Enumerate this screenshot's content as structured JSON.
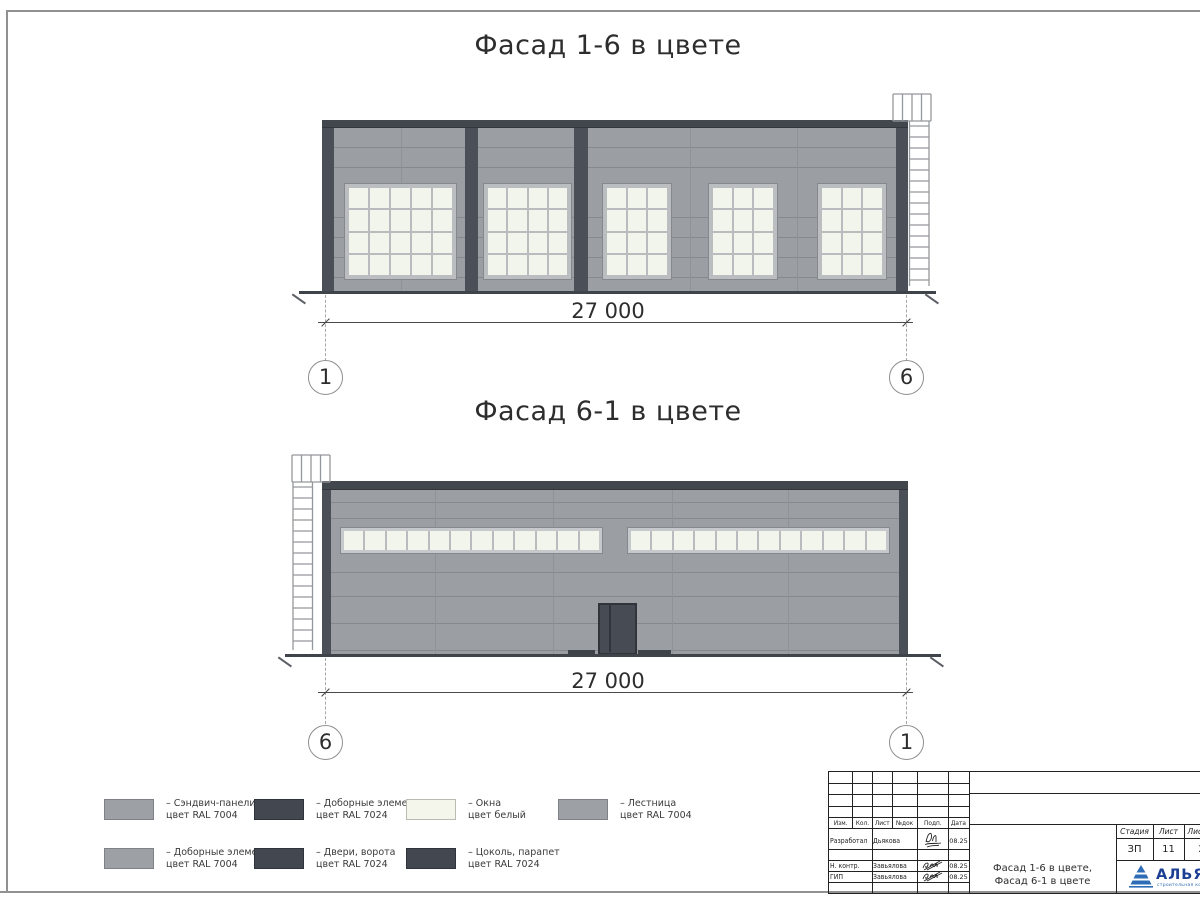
{
  "facade_top": {
    "title": "Фасад 1-6 в цвете",
    "dimension": "27 000",
    "axis_left": "1",
    "axis_right": "6",
    "windows": [
      {
        "cols": 5,
        "rows": 4
      },
      {
        "cols": 4,
        "rows": 4
      },
      {
        "cols": 3,
        "rows": 4
      },
      {
        "cols": 3,
        "rows": 4
      },
      {
        "cols": 3,
        "rows": 4
      }
    ]
  },
  "facade_bottom": {
    "title": "Фасад 6-1 в цвете",
    "dimension": "27 000",
    "axis_left": "6",
    "axis_right": "1",
    "ribbons": [
      {
        "panes": 12
      },
      {
        "panes": 12
      }
    ]
  },
  "legend": {
    "items_row1": [
      {
        "swatch": "gray",
        "line1": "– Сэндвич-панели",
        "line2": "цвет RAL 7004"
      },
      {
        "swatch": "dark",
        "line1": "– Доборные элементы",
        "line2": "цвет RAL 7024"
      },
      {
        "swatch": "white",
        "line1": "– Окна",
        "line2": "цвет белый"
      },
      {
        "swatch": "gray",
        "line1": "– Лестница",
        "line2": "цвет RAL 7004"
      }
    ],
    "items_row2": [
      {
        "swatch": "gray",
        "line1": "– Доборные элементы",
        "line2": "цвет RAL 7004"
      },
      {
        "swatch": "dark",
        "line1": "– Двери, ворота",
        "line2": "цвет RAL 7024"
      },
      {
        "swatch": "dark",
        "line1": "– Цоколь, парапет",
        "line2": "цвет RAL 7024"
      }
    ]
  },
  "title_block": {
    "col_headers": [
      "Изм.",
      "Кол.",
      "Лист",
      "№док",
      "Подп.",
      "Дата"
    ],
    "sign_rows": [
      {
        "role": "Разработал",
        "name": "Дьякова",
        "date": "08.25"
      },
      {
        "role": "Н. контр.",
        "name": "Завьялова",
        "date": "08.25"
      },
      {
        "role": "ГИП",
        "name": "Завьялова",
        "date": "08.25"
      }
    ],
    "doc_title_line1": "Фасад 1-6 в цвете,",
    "doc_title_line2": "Фасад 6-1 в цвете",
    "stage_label": "Стадия",
    "sheet_label": "Лист",
    "sheets_label": "Листов",
    "stage_value": "ЗП",
    "sheet_value": "11",
    "sheets_value": "2",
    "logo_text": "АЛЬЯНС",
    "logo_subtext": "строительная компания"
  },
  "colors": {
    "wall": "#9b9ea3",
    "dark_elements": "#454a52",
    "window_pane": "#f2f5ec",
    "logo_blue": "#2e6db5",
    "logo_navy": "#1c3f94"
  }
}
